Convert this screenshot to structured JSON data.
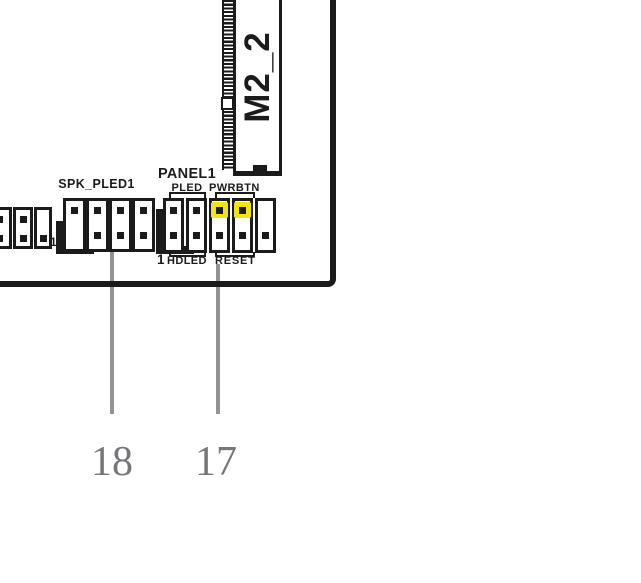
{
  "colors": {
    "ink": "#1b1b1b",
    "highlight": "#f2e313",
    "leader": "#929497",
    "callout": "#76777b"
  },
  "m2_slot": {
    "label": "M2_2"
  },
  "spk_header": {
    "label": "SPK_PLED1"
  },
  "panel_header": {
    "label": "PANEL1",
    "pin1": "1",
    "groups_top": [
      {
        "label": "PLED"
      },
      {
        "label": "PWRBTN"
      }
    ],
    "groups_bottom": [
      {
        "label": "HDLED"
      },
      {
        "label": "RESET"
      }
    ]
  },
  "left_header": {
    "pin1": "1"
  },
  "callouts": [
    {
      "number": "18"
    },
    {
      "number": "17"
    }
  ]
}
